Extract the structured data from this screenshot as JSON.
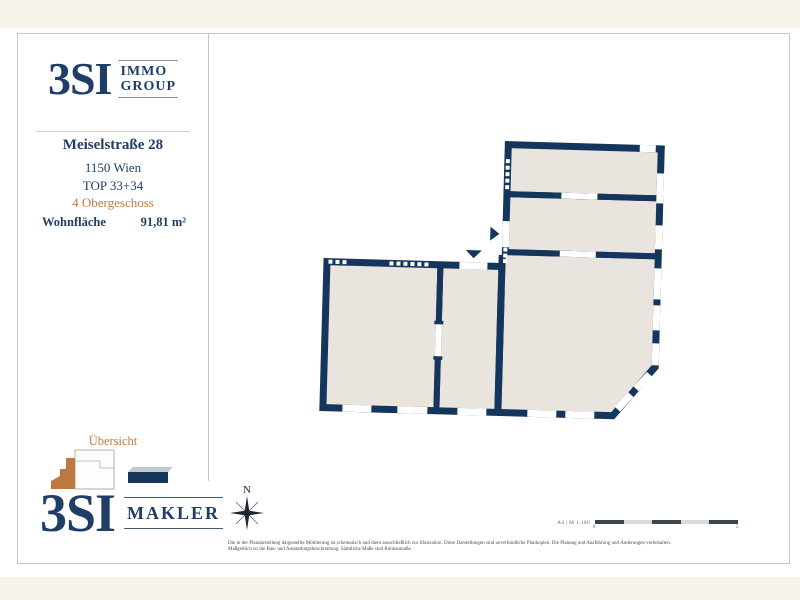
{
  "sidebar": {
    "logo_top": {
      "brand": "3SI",
      "sub1": "IMMO",
      "sub2": "GROUP"
    },
    "address": {
      "street": "Meiselstraße 28",
      "city": "1150 Wien",
      "top": "TOP 33+34",
      "floor": "4 Obergeschoss"
    },
    "area_label": "Wohnfläche",
    "area_value": "91,81 m²",
    "overview_title": "Übersicht",
    "logo_bottom": {
      "brand": "3SI",
      "sub1": "MAKLER"
    }
  },
  "plan": {
    "north_label": "N",
    "scale_text": "A4 | M 1:100",
    "scale_zero": "0",
    "scale_five": "5"
  },
  "footer": {
    "disclaimer_line1": "Die in der Plandarstellung dargestellte Möblierung ist schematisch und dient ausschließlich zur Illustration. Diese Darstellungen sind unverbindliche Plankopien. Die Planung und Ausführung und Änderungen vorbehalten.",
    "disclaimer_line2": "Maßgeblich ist die Bau- und Ausstattungsbeschreibung. Sämtliche Maße sind Rohbaumaße."
  },
  "colors": {
    "wall_navy": "#14365c",
    "room_beige": "#e9e4dd",
    "accent_orange": "#c4793f",
    "text_navy": "#1f3d66",
    "page_cream": "#f8f3ea"
  }
}
